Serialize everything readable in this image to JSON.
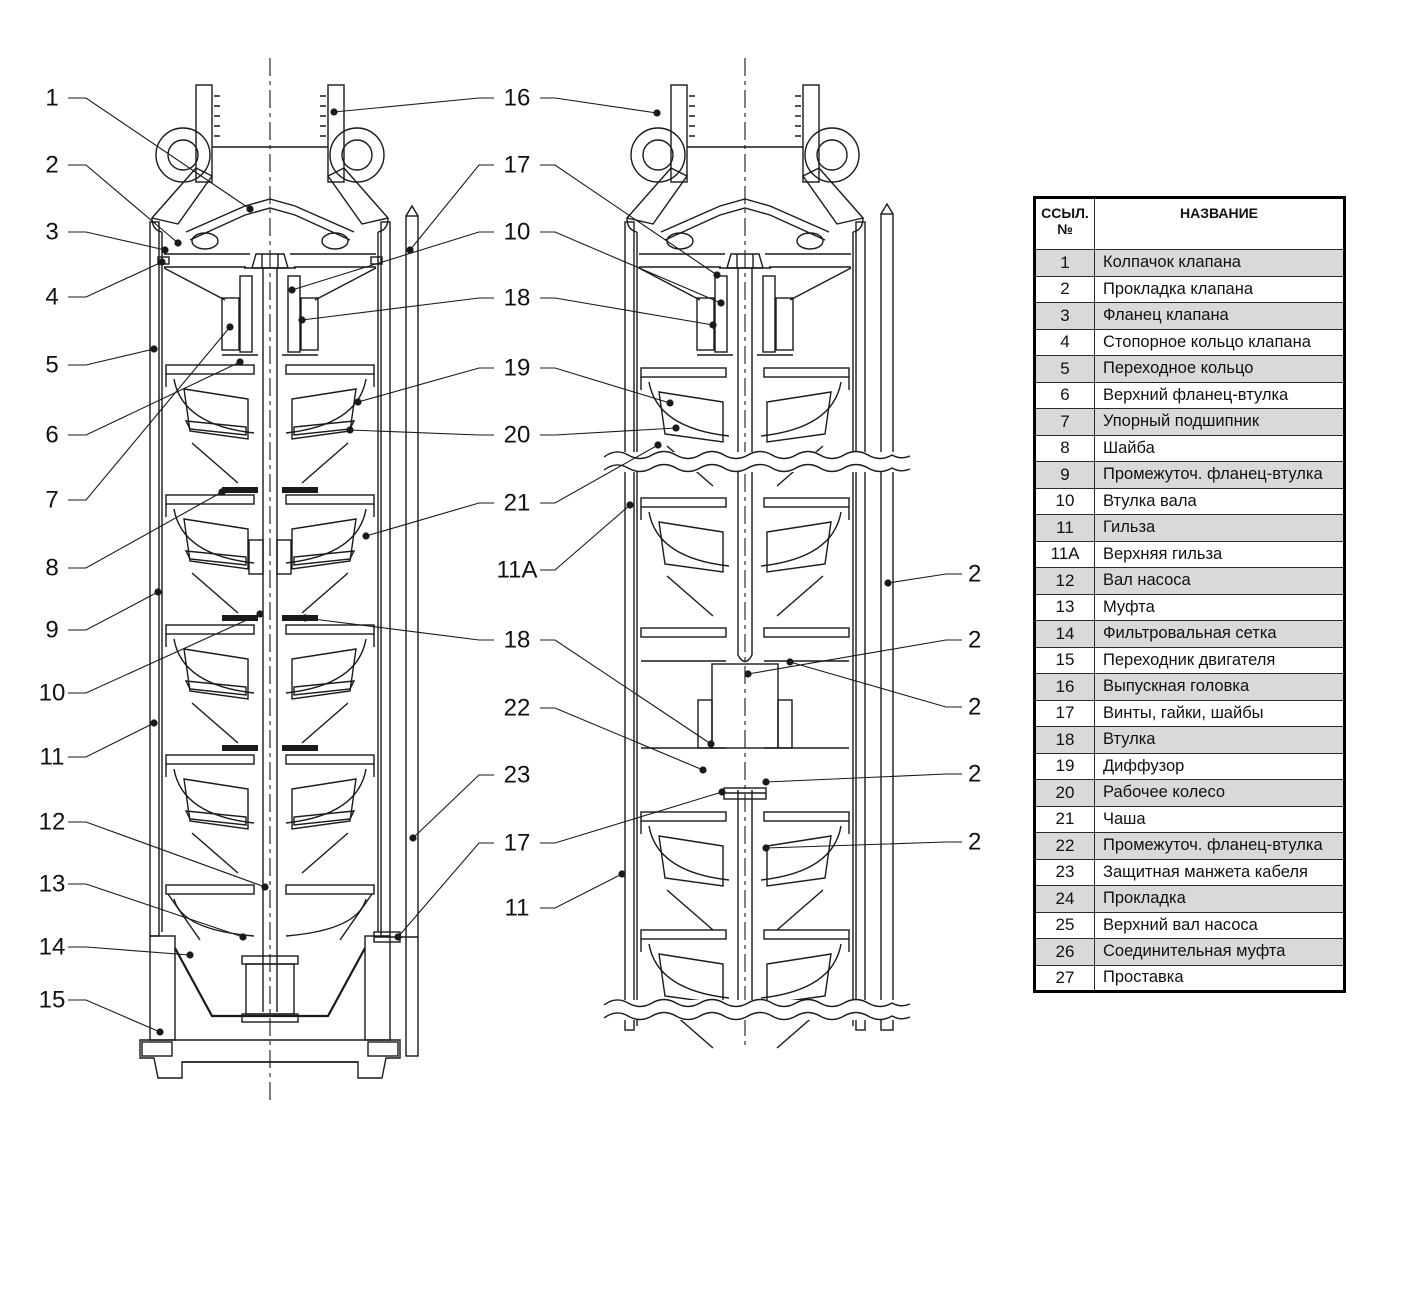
{
  "colors": {
    "line": "#1a1a1a",
    "row_shade": "#d9d9d9",
    "background": "#ffffff"
  },
  "table": {
    "header": {
      "ref_line1": "ССЫЛ.",
      "ref_line2": "№",
      "name": "НАЗВАНИЕ"
    },
    "rows": [
      {
        "ref": "1",
        "name": "Колпачок клапана",
        "shaded": true
      },
      {
        "ref": "2",
        "name": "Прокладка клапана",
        "shaded": false
      },
      {
        "ref": "3",
        "name": "Фланец клапана",
        "shaded": true
      },
      {
        "ref": "4",
        "name": "Стопорное кольцо клапана",
        "shaded": false
      },
      {
        "ref": "5",
        "name": "Переходное кольцо",
        "shaded": true
      },
      {
        "ref": "6",
        "name": "Верхний фланец-втулка",
        "shaded": false
      },
      {
        "ref": "7",
        "name": "Упорный подшипник",
        "shaded": true
      },
      {
        "ref": "8",
        "name": "Шайба",
        "shaded": false
      },
      {
        "ref": "9",
        "name": "Промежуточ. фланец-втулка",
        "shaded": true
      },
      {
        "ref": "10",
        "name": "Втулка вала",
        "shaded": false
      },
      {
        "ref": "11",
        "name": "Гильза",
        "shaded": true
      },
      {
        "ref": "11А",
        "name": "Верхняя гильза",
        "shaded": false
      },
      {
        "ref": "12",
        "name": "Вал насоса",
        "shaded": true
      },
      {
        "ref": "13",
        "name": "Муфта",
        "shaded": false
      },
      {
        "ref": "14",
        "name": "Фильтровальная сетка",
        "shaded": true
      },
      {
        "ref": "15",
        "name": "Переходник двигателя",
        "shaded": false
      },
      {
        "ref": "16",
        "name": "Выпускная головка",
        "shaded": true
      },
      {
        "ref": "17",
        "name": "Винты, гайки, шайбы",
        "shaded": false
      },
      {
        "ref": "18",
        "name": "Втулка",
        "shaded": true
      },
      {
        "ref": "19",
        "name": "Диффузор",
        "shaded": false
      },
      {
        "ref": "20",
        "name": "Рабочее колесо",
        "shaded": true
      },
      {
        "ref": "21",
        "name": "Чаша",
        "shaded": false
      },
      {
        "ref": "22",
        "name": "Промежуточ. фланец-втулка",
        "shaded": true
      },
      {
        "ref": "23",
        "name": "Защитная манжета кабеля",
        "shaded": false
      },
      {
        "ref": "24",
        "name": "Прокладка",
        "shaded": true
      },
      {
        "ref": "25",
        "name": "Верхний вал насоса",
        "shaded": false
      },
      {
        "ref": "26",
        "name": "Соединительная муфта",
        "shaded": true
      },
      {
        "ref": "27",
        "name": "Проставка",
        "shaded": false
      }
    ]
  },
  "callouts": {
    "left_column": [
      {
        "label": "1",
        "y": 98,
        "tx": 250,
        "ty": 209
      },
      {
        "label": "2",
        "y": 165,
        "tx": 178,
        "ty": 243
      },
      {
        "label": "3",
        "y": 232,
        "tx": 165,
        "ty": 250
      },
      {
        "label": "4",
        "y": 297,
        "tx": 162,
        "ty": 262
      },
      {
        "label": "5",
        "y": 365,
        "tx": 154,
        "ty": 349
      },
      {
        "label": "6",
        "y": 435,
        "tx": 240,
        "ty": 362
      },
      {
        "label": "7",
        "y": 500,
        "tx": 230,
        "ty": 327
      },
      {
        "label": "8",
        "y": 568,
        "tx": 222,
        "ty": 492
      },
      {
        "label": "9",
        "y": 630,
        "tx": 158,
        "ty": 592
      },
      {
        "label": "10",
        "y": 693,
        "tx": 260,
        "ty": 614
      },
      {
        "label": "11",
        "y": 757,
        "tx": 154,
        "ty": 723
      },
      {
        "label": "12",
        "y": 822,
        "tx": 265,
        "ty": 887
      },
      {
        "label": "13",
        "y": 884,
        "tx": 243,
        "ty": 937
      },
      {
        "label": "14",
        "y": 947,
        "tx": 190,
        "ty": 955
      },
      {
        "label": "15",
        "y": 1000,
        "tx": 160,
        "ty": 1032
      }
    ],
    "middle_column": [
      {
        "label": "16",
        "y": 98,
        "left": [
          334,
          112
        ],
        "right": [
          657,
          113
        ]
      },
      {
        "label": "17",
        "y": 165,
        "left": [
          410,
          250
        ],
        "right": [
          717,
          275
        ]
      },
      {
        "label": "10",
        "y": 232,
        "left": [
          292,
          290
        ],
        "right": [
          721,
          303
        ]
      },
      {
        "label": "18",
        "y": 298,
        "left": [
          302,
          320
        ],
        "right": [
          713,
          325
        ]
      },
      {
        "label": "19",
        "y": 368,
        "left": [
          358,
          402
        ],
        "right": [
          670,
          403
        ]
      },
      {
        "label": "20",
        "y": 435,
        "left": [
          350,
          430
        ],
        "right": [
          676,
          428
        ]
      },
      {
        "label": "21",
        "y": 503,
        "left": [
          366,
          536
        ],
        "right": [
          658,
          445
        ]
      },
      {
        "label": "11А",
        "y": 570,
        "right": [
          630,
          505
        ]
      },
      {
        "label": "18",
        "y": 640,
        "left": [
          305,
          618
        ],
        "right": [
          711,
          744
        ]
      },
      {
        "label": "22",
        "y": 708,
        "right": [
          703,
          770
        ]
      },
      {
        "label": "23",
        "y": 775,
        "left": [
          413,
          838
        ]
      },
      {
        "label": "17",
        "y": 843,
        "left": [
          398,
          937
        ],
        "right": [
          722,
          792
        ]
      },
      {
        "label": "11",
        "y": 908,
        "right": [
          622,
          874
        ]
      }
    ],
    "right_column": [
      {
        "label": "2",
        "y": 574,
        "tx": 888,
        "ty": 583
      },
      {
        "label": "2",
        "y": 640,
        "tx": 748,
        "ty": 674
      },
      {
        "label": "2",
        "y": 707,
        "tx": 790,
        "ty": 662
      },
      {
        "label": "2",
        "y": 774,
        "tx": 766,
        "ty": 782
      },
      {
        "label": "2",
        "y": 842,
        "tx": 766,
        "ty": 848
      }
    ]
  }
}
